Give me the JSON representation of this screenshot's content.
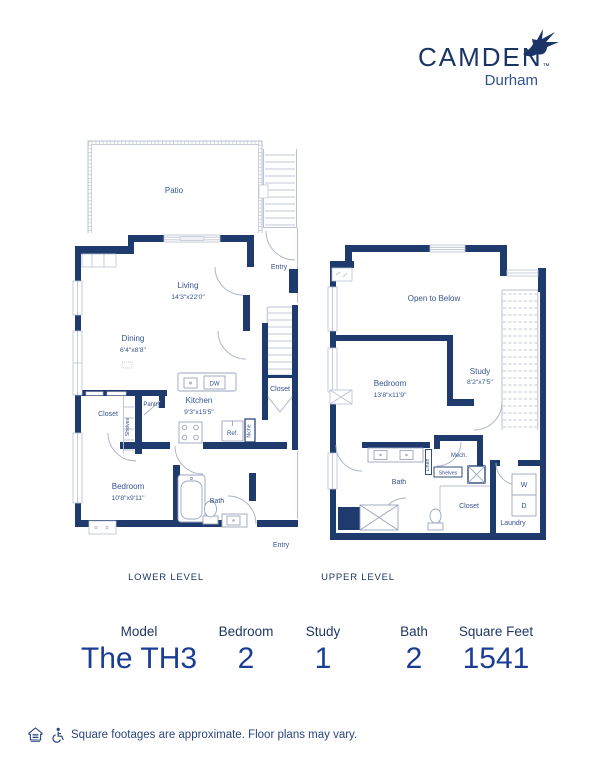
{
  "brand": {
    "name": "CAMDEN",
    "trademark": "™",
    "location": "Durham"
  },
  "plans": {
    "lower": {
      "level_label": "LOWER LEVEL",
      "patio": "Patio",
      "living_name": "Living",
      "living_dims": "14'3\"x22'0\"",
      "dining_name": "Dining",
      "dining_dims": "6'4\"x8'8\"",
      "kitchen_name": "Kitchen",
      "kitchen_dims": "9'3\"x15'5\"",
      "bedroom_name": "Bedroom",
      "bedroom_dims": "10'8\"x9'11\"",
      "bath": "Bath",
      "entry_top": "Entry",
      "entry_bottom": "Entry",
      "closet_stairs": "Closet",
      "closet_bedroom": "Closet",
      "pantry": "Pantry",
      "shelves": "Shelves",
      "niche": "Niche",
      "dishwasher": "DW",
      "refrigerator": "Ref."
    },
    "upper": {
      "level_label": "UPPER LEVEL",
      "open_to_below": "Open to Below",
      "bedroom_name": "Bedroom",
      "bedroom_dims": "13'8\"x11'9\"",
      "study_name": "Study",
      "study_dims": "8'2\"x7'5\"",
      "bath": "Bath",
      "mech": "Mech.",
      "shelves": "Shelves",
      "linen": "Linen",
      "closet": "Closet",
      "laundry": "Laundry",
      "washer": "W",
      "dryer": "D"
    }
  },
  "stats": [
    {
      "label": "Model",
      "value": "The TH3"
    },
    {
      "label": "Bedroom",
      "value": "2"
    },
    {
      "label": "Study",
      "value": "1"
    },
    {
      "label": "Bath",
      "value": "2"
    },
    {
      "label": "Square Feet",
      "value": "1541"
    }
  ],
  "disclaimer": "Square footages are approximate. Floor plans may vary.",
  "colors": {
    "wall_navy": "#1f3a6d",
    "label_blue": "#35538f",
    "value_blue": "#1b3e94",
    "light_line": "#b9c0d0"
  }
}
